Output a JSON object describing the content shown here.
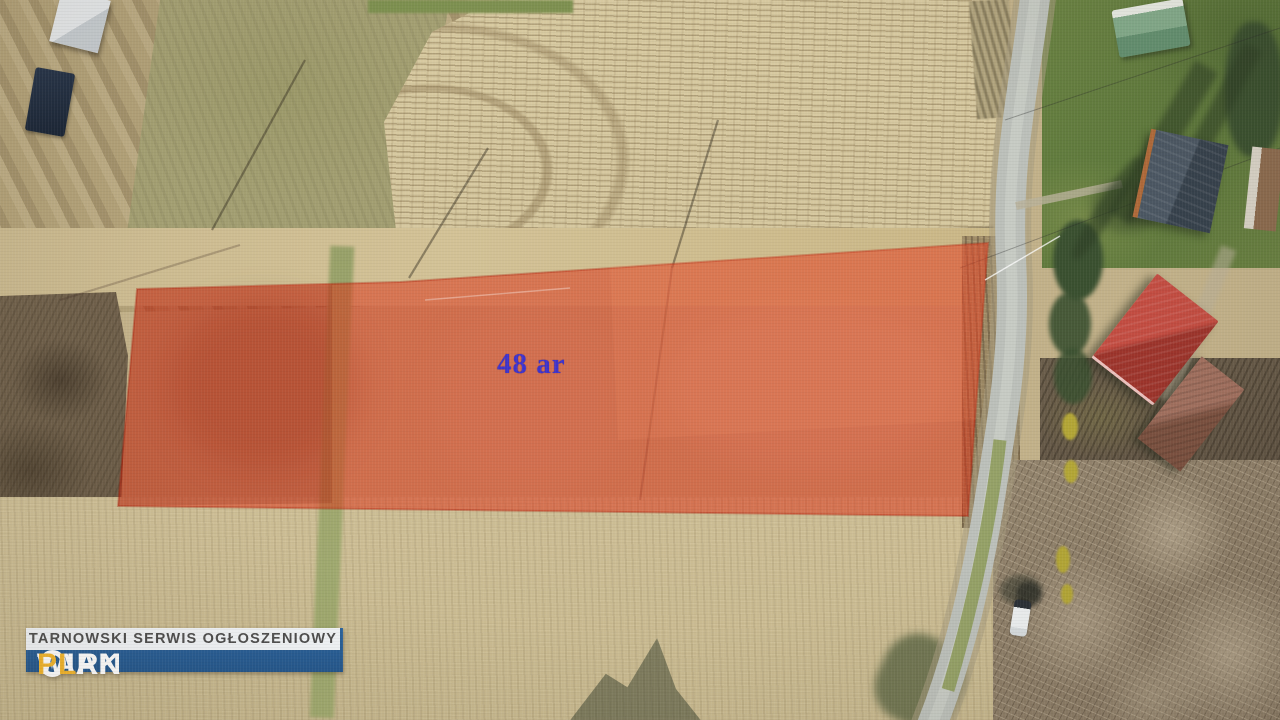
{
  "annotation": {
    "area_label": "48 ar"
  },
  "watermark": {
    "brand_prefix": "TARN",
    "brand_star": "✶",
    "brand_suffix": "WIAK",
    "brand_dot": ".",
    "brand_tld": "PL",
    "tagline": "TARNOWSKI SERWIS OGŁOSZENIOWY"
  },
  "colors": {
    "highlight-red": "#dc2f16",
    "label-blue": "#3f33cb",
    "logo-blue": "#2c649e",
    "logo-blue-dark": "#24578c",
    "logo-yellow": "#f3b62d",
    "logo-tagline-gray": "#4d4d4d",
    "road-gray": "#bcc0ba",
    "field-tan": "#c2b189",
    "plow-tan": "#d6c89f",
    "lawn-green": "#66803f",
    "forest-brown": "#8d7e69"
  }
}
